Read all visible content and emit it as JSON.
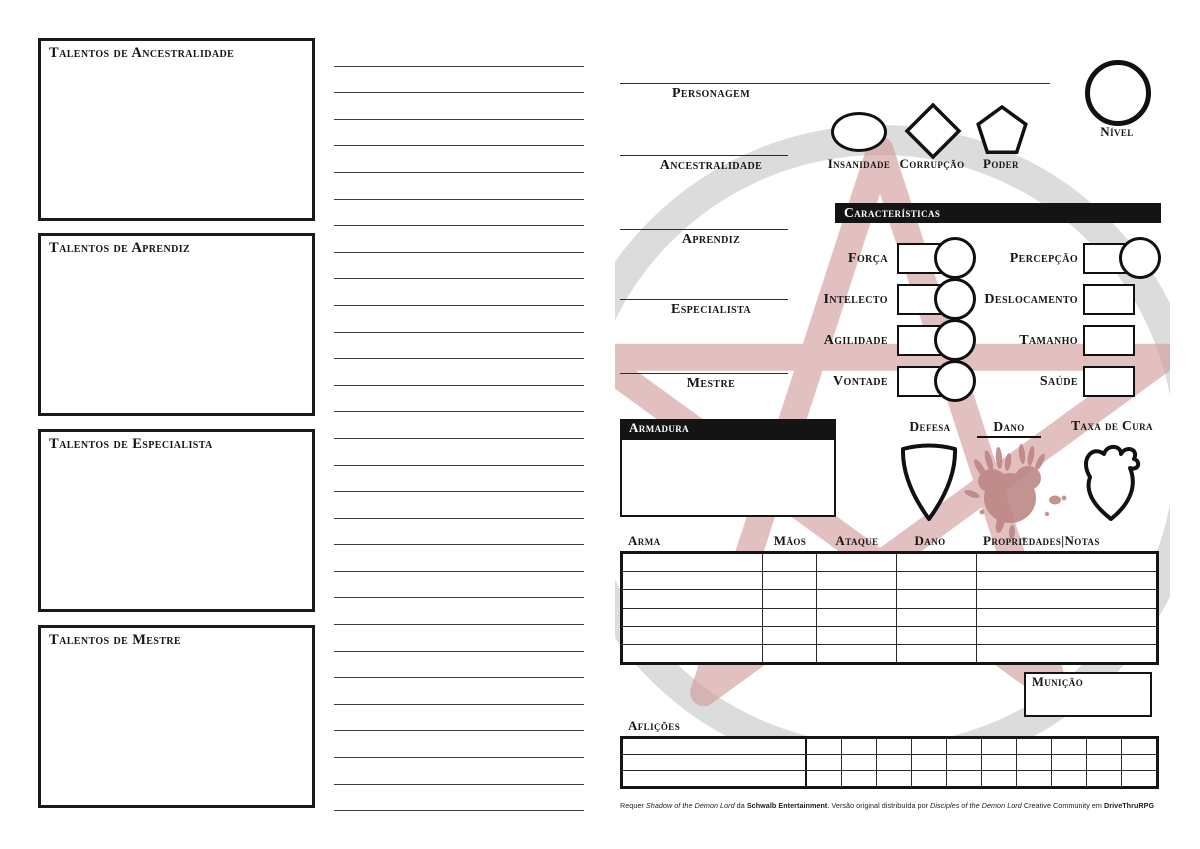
{
  "left_panel": {
    "boxes": [
      {
        "label": "Talentos de Ancestralidade"
      },
      {
        "label": "Talentos de Aprendiz"
      },
      {
        "label": "Talentos de Especialista"
      },
      {
        "label": "Talentos de Mestre"
      }
    ]
  },
  "notes": {
    "line_count": 29
  },
  "identity": {
    "personagem_label": "Personagem",
    "ancestralidade_label": "Ancestralidade",
    "aprendiz_label": "Aprendiz",
    "especialista_label": "Especialista",
    "mestre_label": "Mestre",
    "nivel_label": "Nível",
    "insanidade_label": "Insanidade",
    "corrupcao_label": "Corrupção",
    "poder_label": "Poder"
  },
  "caracteristicas": {
    "title": "Características",
    "left": [
      {
        "label": "Força"
      },
      {
        "label": "Intelecto"
      },
      {
        "label": "Agilidade"
      },
      {
        "label": "Vontade"
      }
    ],
    "right": [
      {
        "label": "Percepção"
      },
      {
        "label": "Deslocamento"
      },
      {
        "label": "Tamanho"
      },
      {
        "label": "Saúde"
      }
    ]
  },
  "combate": {
    "armadura_label": "Armadura",
    "defesa_label": "Defesa",
    "dano_label": "Dano",
    "taxa_de_cura_label": "Taxa de Cura"
  },
  "armas": {
    "headers": [
      "Arma",
      "Mãos",
      "Ataque",
      "Dano",
      "Propriedades|Notas"
    ],
    "row_count": 6
  },
  "municao_label": "Munição",
  "aflicoes": {
    "label": "Aflições",
    "row_count": 3,
    "check_cols": 10
  },
  "footer": {
    "seg0": "Requer ",
    "seg1": "Shadow of the Demon Lord",
    "seg2": " da ",
    "seg3": "Schwalb Entertainment",
    "seg4": ".  Versão original distribuída por ",
    "seg5": "Disciples of the Demon Lord",
    "seg6": " Creative Community em ",
    "seg7": "DriveThruRPG"
  },
  "colors": {
    "ink": "#141414",
    "header_bar": "#141414",
    "watermark_gray": "#dcdcdc",
    "watermark_rose": "#cf9a98",
    "blood_rose": "#bb8584"
  }
}
